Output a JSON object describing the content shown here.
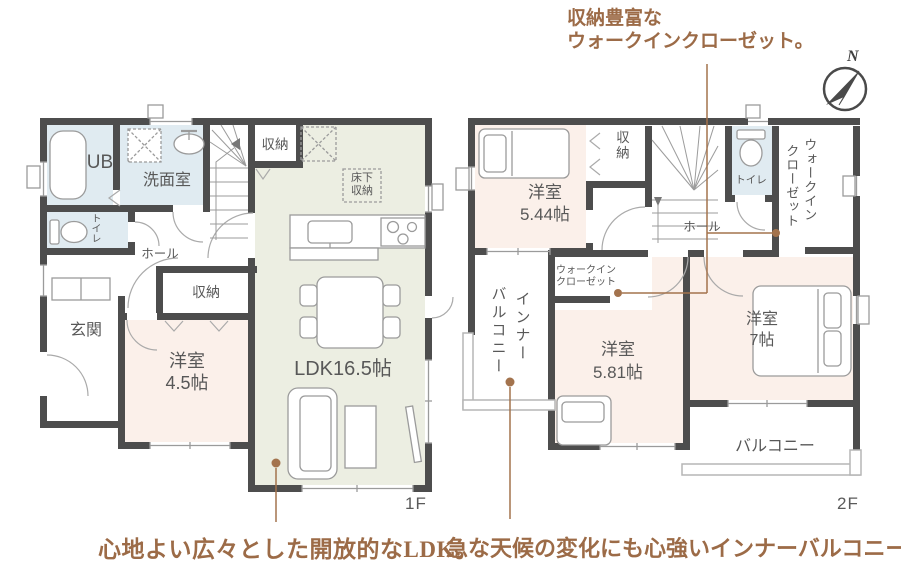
{
  "captions": {
    "top_line1": "収納豊富な",
    "top_line2": "ウォークインクローゼット。",
    "bottom_left": "心地よい広々とした開放的なLDK。",
    "bottom_right": "急な天候の変化にも心強いインナーバルコニー。"
  },
  "compass": {
    "north": "N"
  },
  "floor1": {
    "floor_label": "1F",
    "bath": "UB",
    "washroom": "洗面室",
    "toilet": "トイレ",
    "hall": "ホール",
    "storage_top": "収納",
    "underfloor_line1": "床下",
    "underfloor_line2": "収納",
    "storage_bottom": "収納",
    "entrance": "玄関",
    "bedroom_line1": "洋室",
    "bedroom_line2": "4.5帖",
    "ldk": "LDK16.5帖"
  },
  "floor2": {
    "floor_label": "2F",
    "bedroom544_line1": "洋室",
    "bedroom544_line2": "5.44帖",
    "storage": "収納",
    "toilet": "トイレ",
    "wic_right_col1": "ウォークイン",
    "wic_right_col2": "クローゼット",
    "hall": "ホール",
    "wic_left_line1": "ウォークイン",
    "wic_left_line2": "クローゼット",
    "inner_balcony_col1": "インナー",
    "inner_balcony_col2": "バルコニー",
    "bedroom581_line1": "洋室",
    "bedroom581_line2": "5.81帖",
    "bedroom7_line1": "洋室",
    "bedroom7_line2": "7帖",
    "balcony": "バルコニー"
  },
  "colors": {
    "wall": "#4d4d4d",
    "ldk_fill": "#eceee2",
    "bedroom_fill": "#fbf0ea",
    "wet_fill": "#e0ebf1",
    "accent_brown": "#a3734d"
  }
}
